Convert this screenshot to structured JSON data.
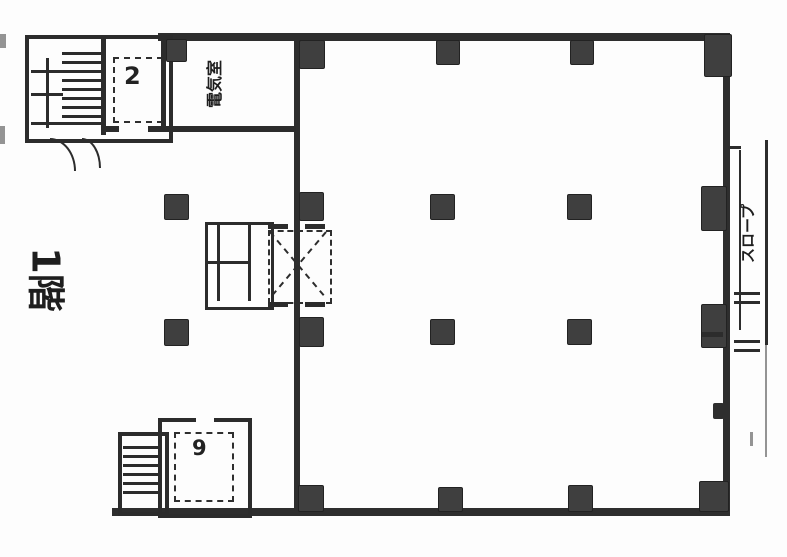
{
  "document": {
    "type": "architectural floor plan (scanned)",
    "floor_label": "1階"
  },
  "labels": {
    "floor": "1階",
    "top_room": "電気室",
    "ramp": "スロープ",
    "upper_small_room_mark": "2",
    "lower_small_room_mark": "9"
  },
  "colors": {
    "background": "#fdfdfd",
    "ink": "#2a2a2a",
    "column_fill": "#3f3f3f"
  },
  "structure": {
    "column_grid_x": [
      165,
      300,
      435,
      570,
      705
    ],
    "column_grid_y": [
      40,
      195,
      320,
      487
    ],
    "features": [
      "stairwell-top-left",
      "stairwell-bottom-left",
      "elevator-shaft-center",
      "exterior-ramp-right"
    ]
  }
}
